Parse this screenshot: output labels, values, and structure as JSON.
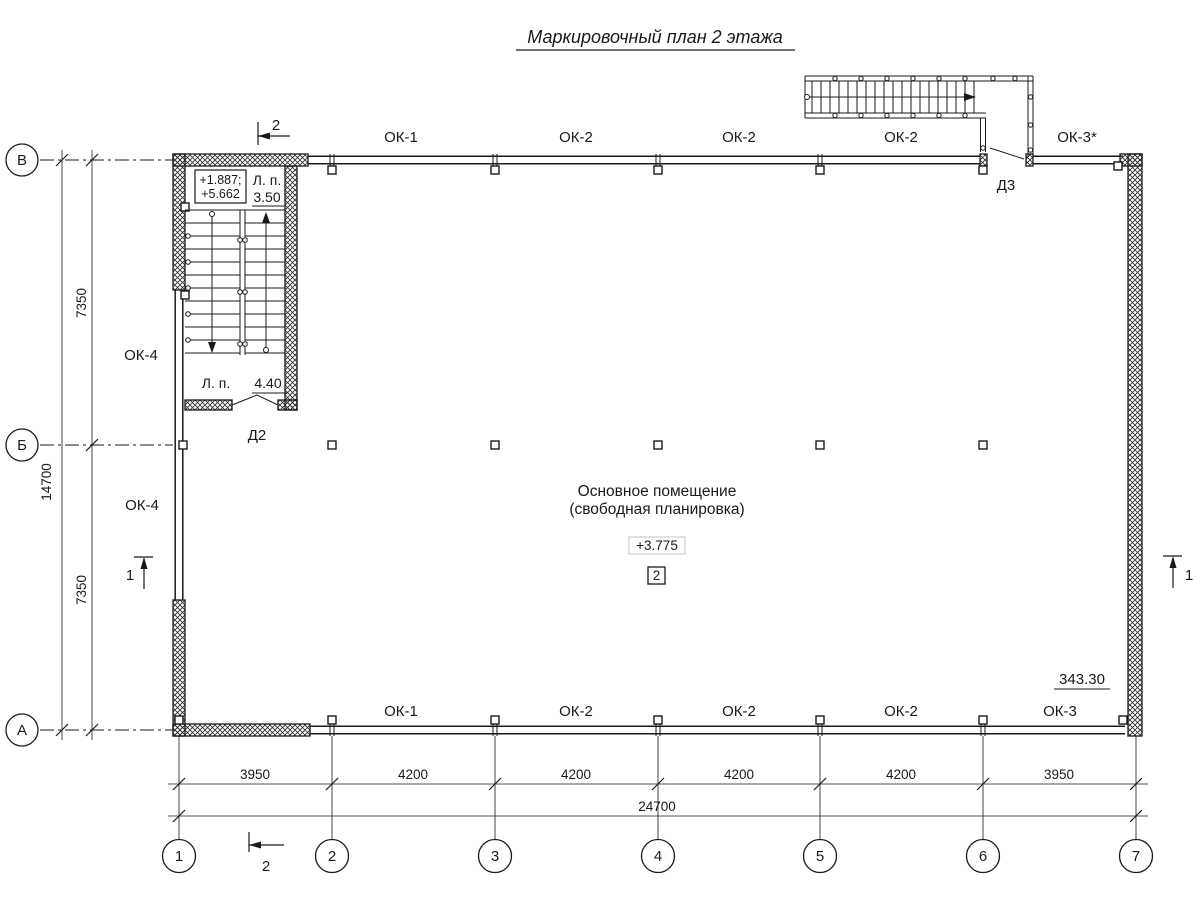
{
  "title": "Маркировочный план 2 этажа",
  "axes": {
    "vertical": [
      "В",
      "Б",
      "А"
    ],
    "horizontal": [
      "1",
      "2",
      "3",
      "4",
      "5",
      "6",
      "7"
    ]
  },
  "dimensions": {
    "left_total": "14700",
    "left_segments": [
      "7350",
      "7350"
    ],
    "bottom_segments": [
      "3950",
      "4200",
      "4200",
      "4200",
      "4200",
      "3950"
    ],
    "bottom_total": "24700"
  },
  "windows": {
    "top": [
      "ОК-1",
      "ОК-2",
      "ОК-2",
      "ОК-2",
      "ОК-3*"
    ],
    "bottom": [
      "ОК-1",
      "ОК-2",
      "ОК-2",
      "ОК-2",
      "ОК-3"
    ],
    "left": [
      "ОК-4",
      "ОК-4"
    ]
  },
  "doors": {
    "d2": "Д2",
    "d3": "Д3"
  },
  "stairwell": {
    "elevation_line1": "+1.887;",
    "elevation_line2": "+5.662",
    "landing_upper_label": "Л. п.",
    "landing_upper_value": "3.50",
    "landing_lower_label": "Л. п.",
    "landing_lower_value": "4.40"
  },
  "room": {
    "name_line1": "Основное помещение",
    "name_line2": "(свободная планировка)",
    "elevation": "+3.775",
    "number": "2",
    "area": "343.30"
  },
  "section_marks": {
    "mark1": "1",
    "mark2": "2"
  }
}
